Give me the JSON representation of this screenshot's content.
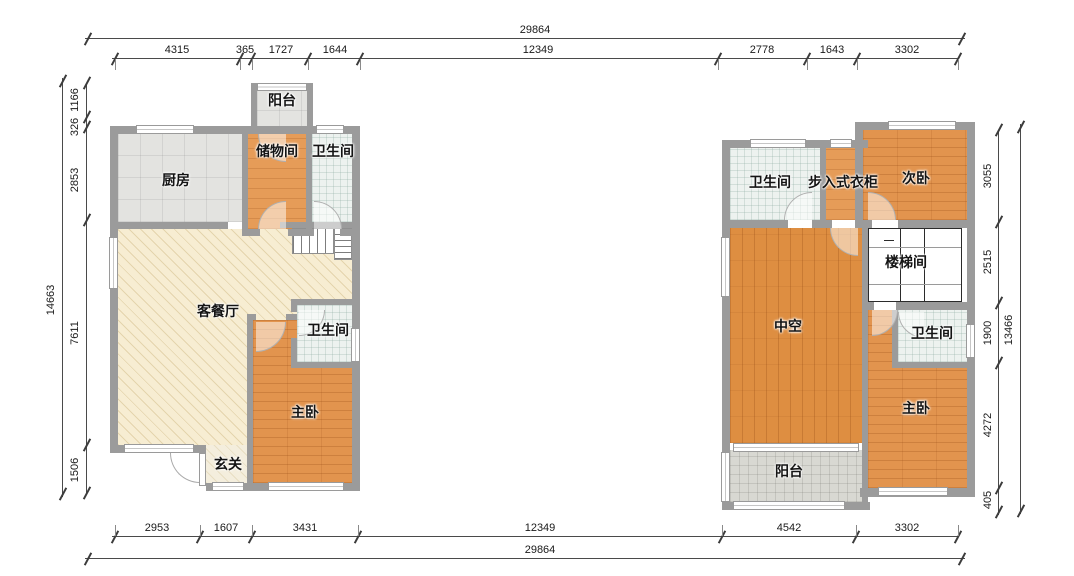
{
  "colors": {
    "wall": "#9b9b9b",
    "wood_floor": "#e2944e",
    "void_floor": "#de8e41",
    "beige_floor": "#f7edd2",
    "tile_gray": "#e3e3e0",
    "tile_bath": "#edf2ef",
    "balcony_gray": "#d8d8d2",
    "dim_line": "#4a4a4a",
    "background": "#ffffff"
  },
  "dims": {
    "top": {
      "total": "29864",
      "segments": [
        "4315",
        "365",
        "1727",
        "1644",
        "12349",
        "2778",
        "1643",
        "3302"
      ]
    },
    "bottom": {
      "total": "29864",
      "segments": [
        "2953",
        "1607",
        "3431",
        "12349",
        "4542",
        "3302"
      ]
    },
    "left": {
      "total": "14663",
      "segments": [
        "1166",
        "326",
        "2853",
        "7611",
        "1506"
      ]
    },
    "right": {
      "total": "13466",
      "segments": [
        "3055",
        "2515",
        "1900",
        "4272",
        "405"
      ]
    }
  },
  "floor1": {
    "rooms": {
      "balcony": "阳台",
      "kitchen": "厨房",
      "storage": "储物间",
      "bath_top": "卫生间",
      "living": "客餐厅",
      "bath_mid": "卫生间",
      "master": "主卧",
      "entry": "玄关"
    }
  },
  "floor2": {
    "rooms": {
      "bath_top": "卫生间",
      "closet": "步入式衣柜",
      "second_bedroom": "次卧",
      "stairwell": "楼梯间",
      "void": "中空",
      "bath_mid": "卫生间",
      "master": "主卧",
      "balcony": "阳台"
    }
  }
}
